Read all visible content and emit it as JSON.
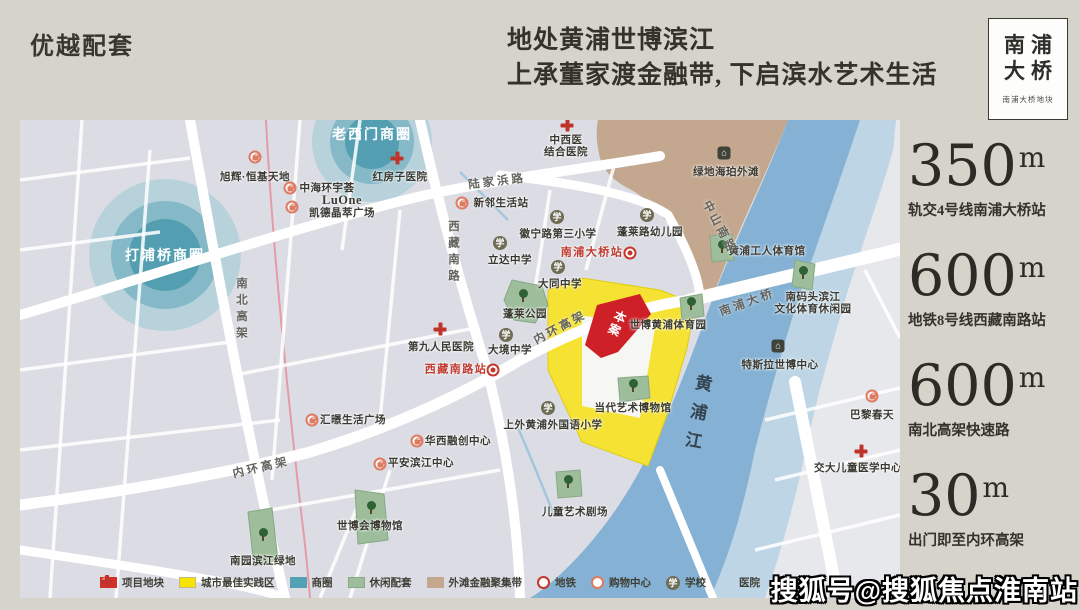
{
  "header": {
    "title": "优越配套",
    "headline_line1": "地处黄浦世博滨江",
    "headline_line2": "上承董家渡金融带, 下启滨水艺术生活",
    "brand": {
      "line1": "南浦",
      "line2": "大桥",
      "subtitle": "南浦大桥地块"
    }
  },
  "stats": [
    {
      "value": "350",
      "unit": "m",
      "label": "轨交4号线南浦大桥站"
    },
    {
      "value": "600",
      "unit": "m",
      "label": "地铁8号线西藏南路站"
    },
    {
      "value": "600",
      "unit": "m",
      "label": "南北高架快速路"
    },
    {
      "value": "30",
      "unit": "m",
      "label": "出门即至内环高架"
    }
  ],
  "map": {
    "plot_label": "本案",
    "icon_glyphs": {
      "school": "学",
      "residence": "⌂"
    },
    "business_circles": [
      {
        "name": "打浦桥商圈",
        "x": 145,
        "y": 135
      },
      {
        "name": "老西门商圈",
        "x": 352,
        "y": 14
      }
    ],
    "road_labels": [
      {
        "text": "南北高架",
        "x": 221,
        "y": 190,
        "vertical": true
      },
      {
        "text": "西藏南路",
        "x": 433,
        "y": 133,
        "vertical": true
      },
      {
        "text": "陆家浜路",
        "x": 477,
        "y": 61,
        "rotate": -7
      },
      {
        "text": "中山南路",
        "x": 700,
        "y": 107,
        "rotate": 62
      },
      {
        "text": "内环高架",
        "x": 540,
        "y": 207,
        "rotate": -28
      },
      {
        "text": "内环高架",
        "x": 241,
        "y": 347,
        "rotate": -13
      },
      {
        "text": "南浦大桥",
        "x": 727,
        "y": 182,
        "rotate": -20
      },
      {
        "text": "黄浦江",
        "x": 676,
        "y": 297,
        "vertical": true,
        "river": true,
        "rotate": 10
      }
    ],
    "pois": [
      {
        "type": "shopping",
        "label": "旭辉·恒基天地",
        "x": 235,
        "y": 37,
        "lx": 235,
        "ly": 57
      },
      {
        "type": "shopping",
        "label": "中海环宇荟",
        "x": 270,
        "y": 68,
        "lx": 307,
        "ly": 68
      },
      {
        "type": "shopping",
        "label": "LuOne",
        "label2": "凯德晶萃广场",
        "cls": "luone",
        "x": 272,
        "y": 87,
        "lx": 322,
        "ly": 86
      },
      {
        "type": "shopping",
        "label": "新邻生活站",
        "x": 442,
        "y": 83,
        "lx": 481,
        "ly": 83
      },
      {
        "type": "shopping",
        "label": "汇暻生活广场",
        "x": 292,
        "y": 300,
        "lx": 333,
        "ly": 300
      },
      {
        "type": "shopping",
        "label": "华西融创中心",
        "x": 397,
        "y": 321,
        "lx": 438,
        "ly": 321
      },
      {
        "type": "shopping",
        "label": "平安滨江中心",
        "x": 360,
        "y": 344,
        "lx": 401,
        "ly": 343
      },
      {
        "type": "shopping",
        "label": "巴黎春天",
        "x": 852,
        "y": 276,
        "lx": 852,
        "ly": 295
      },
      {
        "type": "metro",
        "cls": "metro-label",
        "label": "南浦大桥站",
        "x": 610,
        "y": 133,
        "lx": 572,
        "ly": 133
      },
      {
        "type": "metro",
        "cls": "metro-label",
        "label": "西藏南路站",
        "x": 473,
        "y": 250,
        "lx": 436,
        "ly": 250
      },
      {
        "type": "school",
        "label": "徽宁路第三小学",
        "x": 537,
        "y": 97,
        "lx": 538,
        "ly": 114
      },
      {
        "type": "school",
        "label": "蓬莱路幼儿园",
        "x": 627,
        "y": 95,
        "lx": 630,
        "ly": 112
      },
      {
        "type": "school",
        "label": "立达中学",
        "x": 480,
        "y": 123,
        "lx": 490,
        "ly": 140
      },
      {
        "type": "school",
        "label": "大同中学",
        "x": 538,
        "y": 147,
        "lx": 540,
        "ly": 164
      },
      {
        "type": "school",
        "label": "大境中学",
        "x": 486,
        "y": 215,
        "lx": 490,
        "ly": 230
      },
      {
        "type": "school",
        "label": "上外黄浦外国语小学",
        "x": 528,
        "y": 288,
        "lx": 533,
        "ly": 305
      },
      {
        "type": "hospital",
        "label": "红房子医院",
        "x": 377,
        "y": 38,
        "lx": 380,
        "ly": 57
      },
      {
        "type": "hospital",
        "label": "中西医",
        "label2": "结合医院",
        "x": 547,
        "y": 5,
        "lx": 546,
        "ly": 26
      },
      {
        "type": "hospital",
        "label": "第九人民医院",
        "x": 420,
        "y": 209,
        "lx": 421,
        "ly": 227
      },
      {
        "type": "hospital",
        "label": "交大儿童医学中心",
        "x": 841,
        "y": 331,
        "lx": 838,
        "ly": 348
      },
      {
        "type": "park",
        "label": "蓬莱公园",
        "x": 503,
        "y": 176,
        "lx": 505,
        "ly": 194
      },
      {
        "type": "park",
        "label": "世博黄浦体育园",
        "x": 671,
        "y": 184,
        "lx": 648,
        "ly": 205
      },
      {
        "type": "park",
        "label": "当代艺术博物馆",
        "x": 613,
        "y": 266,
        "lx": 613,
        "ly": 288
      },
      {
        "type": "park",
        "label": "南码头滨江",
        "label2": "文化体育休闲园",
        "x": 783,
        "y": 153,
        "lx": 793,
        "ly": 183
      },
      {
        "type": "park",
        "label": "南园滨江绿地",
        "x": 243,
        "y": 415,
        "lx": 243,
        "ly": 441
      },
      {
        "type": "park",
        "label": "世博会博物馆",
        "x": 351,
        "y": 388,
        "lx": 350,
        "ly": 406
      },
      {
        "type": "park",
        "label": "儿童艺术剧场",
        "x": 548,
        "y": 362,
        "lx": 555,
        "ly": 392
      },
      {
        "type": "park",
        "label": "黄浦工人体育馆",
        "x": 702,
        "y": 127,
        "lx": 747,
        "ly": 131
      },
      {
        "type": "building",
        "label": "绿地海珀外滩",
        "x": 704,
        "y": 33,
        "lx": 706,
        "ly": 52
      },
      {
        "type": "building",
        "label": "特斯拉世博中心",
        "x": 758,
        "y": 226,
        "lx": 760,
        "ly": 245
      }
    ]
  },
  "legend": {
    "items": [
      {
        "type": "plot",
        "label": "项目地块"
      },
      {
        "type": "practice",
        "label": "城市最佳实践区"
      },
      {
        "type": "circle",
        "label": "商圈"
      },
      {
        "type": "leisure",
        "label": "休闲配套"
      },
      {
        "type": "bund",
        "label": "外滩金融聚集带"
      },
      {
        "type": "metro",
        "label": "地铁"
      },
      {
        "type": "shopping",
        "label": "购物中心"
      },
      {
        "type": "school",
        "label": "学校"
      },
      {
        "type": "hospital",
        "label": "医院"
      },
      {
        "type": "residence",
        "label": "住宅区"
      }
    ]
  },
  "watermark": "搜狐号@搜狐焦点淮南站",
  "colors": {
    "page_bg": "#d6d3ca",
    "map_bg": "#dcdde4",
    "plot_red": "#ce2127",
    "practice_yellow": "#f5e233",
    "circle_teal": "#4e9cae",
    "leisure_green": "#9dbd9b",
    "bund_tan": "#c3a88f",
    "river_blue": "#85b2d4",
    "metro_red": "#c5362d",
    "shopping_orange": "#dd7a62",
    "metro_line_pink": "#e59aa8"
  }
}
